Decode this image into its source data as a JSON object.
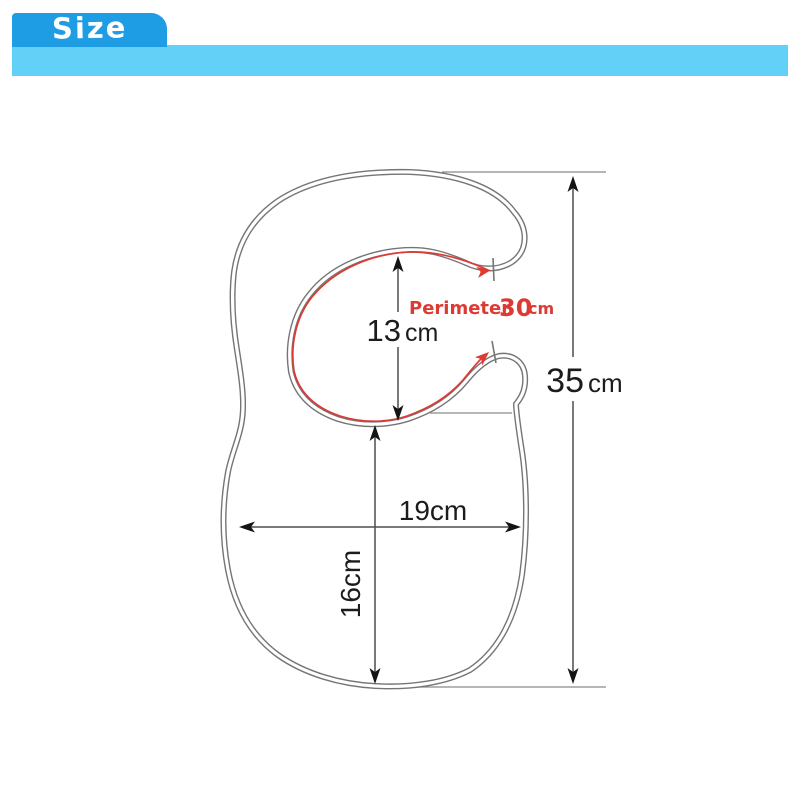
{
  "banner": {
    "tab_label": "Size",
    "tab_color": "#1e9ce4",
    "bar_color": "#63d1f7",
    "text_color": "#ffffff"
  },
  "diagram": {
    "subject": "baby-bib-size-diagram",
    "outline_color": "#757575",
    "dimension_color": "#4d4d4d",
    "accent_color": "#dd3a33",
    "measurements": {
      "neck_opening_height": {
        "value": "13",
        "unit": "cm"
      },
      "neck_perimeter": {
        "label": "Perimeter",
        "value": "30",
        "unit": "cm"
      },
      "total_height": {
        "value": "35",
        "unit": "cm"
      },
      "body_width": {
        "value": "19cm"
      },
      "body_height": {
        "value": "16cm"
      }
    }
  }
}
